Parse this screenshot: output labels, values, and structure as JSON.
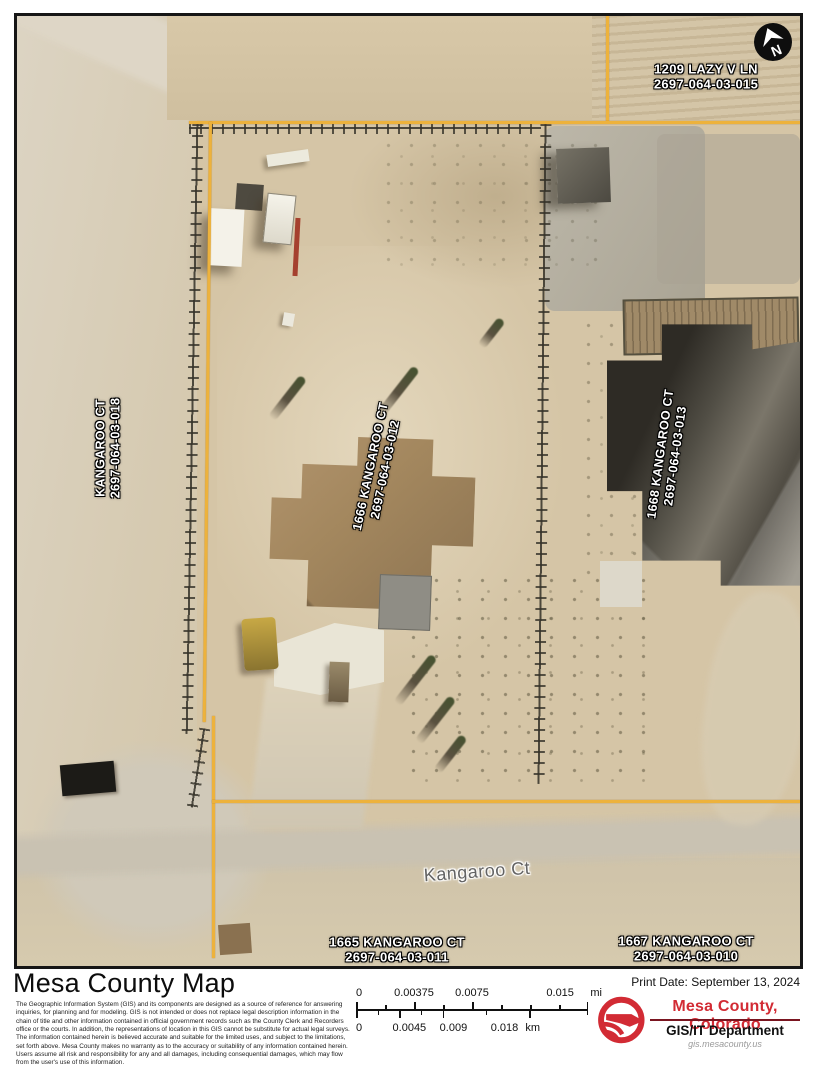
{
  "map": {
    "north_letter": "N",
    "street_label": "Kangaroo Ct",
    "parcel_line_color": "#edb23c",
    "parcels": [
      {
        "address": "1209 LAZY V LN",
        "parcel_id": "2697-064-03-015"
      },
      {
        "address": "KANGAROO CT",
        "parcel_id": "2697-064-03-018"
      },
      {
        "address": "1666 KANGAROO CT",
        "parcel_id": "2697-064-03-012"
      },
      {
        "address": "1668 KANGAROO CT",
        "parcel_id": "2697-064-03-013"
      },
      {
        "address": "1665 KANGAROO CT",
        "parcel_id": "2697-064-03-011"
      },
      {
        "address": "1667 KANGAROO CT",
        "parcel_id": "2697-064-03-010"
      }
    ]
  },
  "footer": {
    "title": "Mesa County Map",
    "disclaimer1": "The Geographic Information System (GIS) and its components are designed as a source of reference for answering inquiries, for planning and for modeling. GIS is not intended or does not replace legal description information in the chain of title and other information contained in official government records such as the County Clerk and Recorders office or the courts. In addition, the representations of location in this GIS cannot be substitute for actual legal surveys.",
    "disclaimer2": "The information contained herein is believed accurate and suitable for the limited uses, and subject to the limitations, set forth above. Mesa County makes no warranty as to the accuracy or suitability of any information contained herein.  Users assume all risk and responsibility for any and all damages, including consequential damages, which may flow from the user's use of this information.",
    "print_date_label": "Print Date:",
    "print_date_value": "September 13, 2024",
    "scalebar": {
      "mi_ticks": [
        "0",
        "0.00375",
        "0.0075",
        "0.015"
      ],
      "mi_unit": "mi",
      "km_ticks": [
        "0",
        "0.0045",
        "0.009",
        "0.018"
      ],
      "km_unit": "km"
    },
    "logo": {
      "org": "Mesa County, Colorado",
      "dept": "GIS/IT Department",
      "url": "gis.mesacounty.us",
      "accent": "#d22b34"
    }
  }
}
